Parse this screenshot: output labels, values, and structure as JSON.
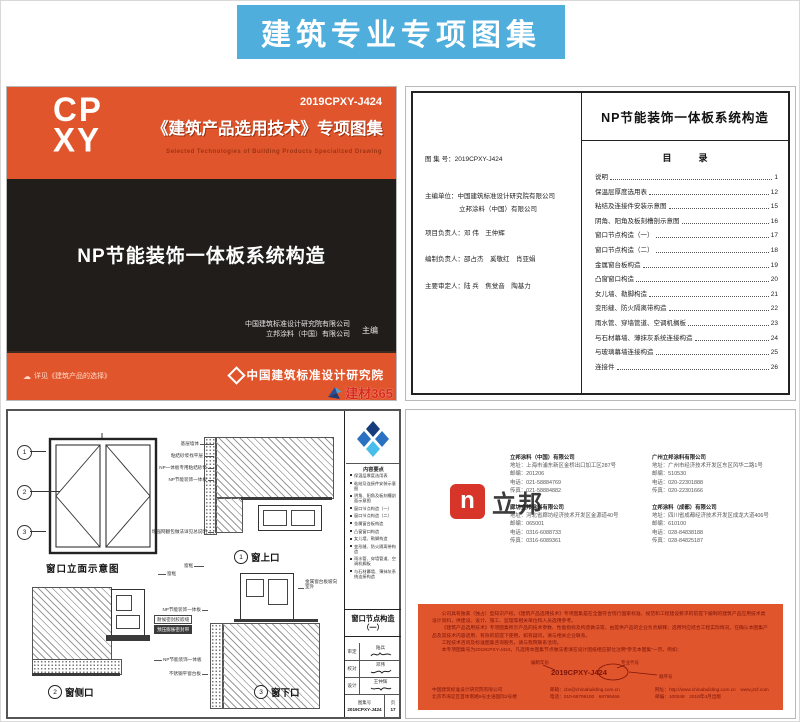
{
  "banner": {
    "title": "建筑专业专项图集",
    "bg_color": "#4FAEDC"
  },
  "cover": {
    "logo_line1": "CP",
    "logo_line2": "XY",
    "code": "2019CPXY-J424",
    "series_title": "《建筑产品选用技术》专项图集",
    "series_subtitle_en": "Selected Technologies of Building Products Specialized Drawing",
    "book_title": "NP节能装饰一体板系统构造",
    "editor_org1": "中国建筑标准设计研究院有限公司",
    "editor_org2": "立邦涂料（中国）有限公司",
    "editor_role": "主编",
    "footer_left": "详见《建筑产品的选择》",
    "footer_right": "中国建筑标准设计研究院",
    "watermark": "建材365"
  },
  "toc": {
    "page_title": "NP节能装饰一体板系统构造",
    "heading": "目　　　录",
    "info_lines": [
      "图 集 号：2019CPXY-J424",
      "主编单位：中国建筑标准设计研究院有限公司",
      "立邦涂料（中国）有限公司",
      "项目负责人：邓  伟　王仲辉",
      "编制负责人：邵占杰　奚敬红　肖亚娟",
      "主要审定人：陆  兵　焦觉音　陶基力"
    ],
    "items": [
      {
        "label": "说明",
        "page": "1"
      },
      {
        "label": "保温层厚度选用表",
        "page": "12"
      },
      {
        "label": "粘结及连接件安装示意图",
        "page": "15"
      },
      {
        "label": "阴角、阳角及板刻槽剖示意图",
        "page": "16"
      },
      {
        "label": "窗口节点构造（一）",
        "page": "17"
      },
      {
        "label": "窗口节点构造（二）",
        "page": "18"
      },
      {
        "label": "金属窗台板构造",
        "page": "19"
      },
      {
        "label": "凸窗窗口构造",
        "page": "20"
      },
      {
        "label": "女儿墙、勒脚构造",
        "page": "21"
      },
      {
        "label": "变形缝、防火隔离带构造",
        "page": "22"
      },
      {
        "label": "雨水管、穿墙管道、空调机搁板",
        "page": "23"
      },
      {
        "label": "与石材幕墙、薄抹灰系统连接构造",
        "page": "24"
      },
      {
        "label": "与玻璃幕墙连接构造",
        "page": "25"
      },
      {
        "label": "连接件",
        "page": "26"
      }
    ]
  },
  "drawing": {
    "elevation_caption": "窗口立面示意图",
    "markers": [
      "1",
      "2",
      "3"
    ],
    "details": [
      {
        "num": "1",
        "label": "窗上口"
      },
      {
        "num": "2",
        "label": "窗侧口"
      },
      {
        "num": "3",
        "label": "窗下口"
      }
    ],
    "ann": {
      "a1": "基层墙体",
      "a2": "粘结砂浆找平层",
      "a3": "NP一体板专用粘结砂浆",
      "a4": "NP节能装饰一体板",
      "a5": "增强网翻包做法详见总说明",
      "a6": "窗框",
      "a7": "耐候密封胶嵌缝",
      "a8": "预压膨胀密封带",
      "a9": "NP节能装饰一体板",
      "a10": "窗框",
      "a11": "金属窗台板坡向室外",
      "a12": "NP节能装饰一体板",
      "a13": "不锈钢平窗台板"
    },
    "titleblock": {
      "contents_heading": "内容要点",
      "contents": [
        "保温层厚度选用表",
        "粘结及连接件安装示意图",
        "阴角、阳角及板刻槽剖面示意图",
        "窗口节点构造（一）",
        "窗口节点构造（二）",
        "金属窗台板构造",
        "凸窗窗口构造",
        "女儿墙、勒脚构造",
        "变形缝、防火隔离带构造",
        "雨水管、穿墙管道、空调机搁板",
        "与石材幕墙、薄抹灰系统连接构造"
      ],
      "sheet_title": "窗口节点构造",
      "sheet_title2": "（一）",
      "sign_rows": [
        {
          "role": "审定",
          "name": "陆兵"
        },
        {
          "role": "校对",
          "name": "邓伟"
        },
        {
          "role": "设计",
          "name": "王仲辉"
        }
      ],
      "atlas_label": "图集号",
      "atlas_no": "2019CPXY-J424",
      "page_label": "页",
      "page_no": "17"
    }
  },
  "contact": {
    "logo_letter": "n",
    "logo_text": "立邦",
    "companies": [
      {
        "name": "立邦涂料（中国）有限公司",
        "address": "地址：上海市浦东新区金桥出口加工区287号",
        "zip": "邮编：201206",
        "tel": "电话：021-58884769",
        "fax": "传真：021-58884882"
      },
      {
        "name": "廊坊立邦涂料有限公司",
        "address": "地址：河北省廊坊经济技术开发区金源道40号",
        "zip": "邮编：065001",
        "tel": "电话：0316-6088733",
        "fax": "传真：0316-6089361"
      },
      {
        "name": "广州立邦涂料有限公司",
        "address": "地址：广州市经济技术开发区东区风华二路1号",
        "zip": "邮编：510530",
        "tel": "电话：020-22301888",
        "fax": "传真：020-22301666"
      },
      {
        "name": "立邦涂料（成都）有限公司",
        "address": "地址：四川省成都经济技术开发区成龙大道406号",
        "zip": "邮编：610100",
        "tel": "电话：028-84838188",
        "fax": "传真：028-84825187"
      }
    ],
    "notice": {
      "p1": "公司具有独家（独占）型知识产权，《建筑产品选用技术》专项图集是在全面符合现行国家标准、规范和工程建设要求的前提下编制的建筑产品应用技术类设计资料，供建设、设计、施工、监理等相关单位和人员选用参考。",
      "p2": "《建筑产品选用技术》专项图集所示产品的技术参数、性能指标及构造做法等，由提供产品的企业负责解释；选用时应结合工程实际情况，在确认本图集产品及其技术内容适用、有效的前提下使用，如有疑问，请与相关企业联系。",
      "p3": "工程技术咨询及标准图集咨询服务，请与我院联系洽询。",
      "p4": "本专项图集号为2019CPXY-J424，凡选用本图集节点做法者请在设计图纸相应部位注明“参见本图集”一页，例如："
    },
    "diagram": {
      "code": "2019CPXY-J424",
      "label_year": "编制年份",
      "label_major": "专业代号",
      "label_seq": "顺序号"
    },
    "footer": {
      "org": "中国建筑标准设计研究院有限公司",
      "org_addr": "北京市海淀区首体南路9号主语国际2号楼",
      "email": "邮箱：cbs@chinabuilding.com.cn",
      "tel": "电话：010-68799100　68799466",
      "web": "网址：http://www.chinabuilding.com.cn　www.jzcf.com",
      "zip": "邮编：100048",
      "pub": "2019年4月出版"
    }
  }
}
